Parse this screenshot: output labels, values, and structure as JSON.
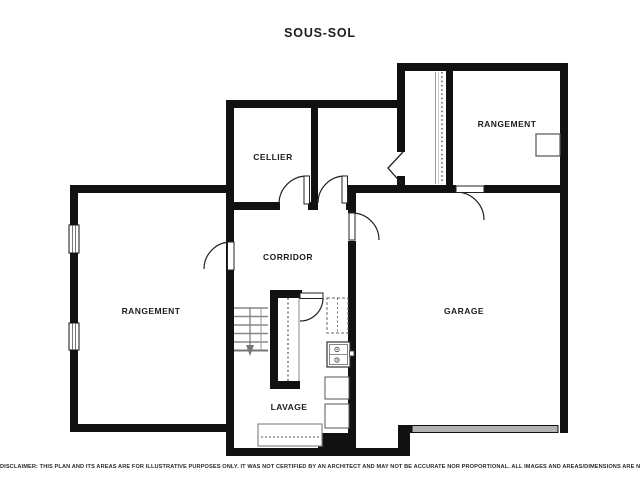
{
  "title": "SOUS-SOL",
  "rooms": {
    "cellier": "CELLIER",
    "rangement_top_right": "RANGEMENT",
    "rangement_left": "RANGEMENT",
    "corridor": "CORRIDOR",
    "garage": "GARAGE",
    "lavage": "LAVAGE"
  },
  "disclaimer": "DISCLAIMER: THIS PLAN AND ITS AREAS ARE FOR ILLUSTRATIVE PURPOSES ONLY. IT WAS NOT CERTIFIED BY AN ARCHITECT AND MAY NOT BE ACCURATE NOR PROPORTIONAL. ALL IMAGES AND AREAS/DIMENSIONS ARE NOT INTENDED TO FORM ANY CONTRACT OR WARRANTY.",
  "colors": {
    "wall": "#111111",
    "garage_door_fill": "#b3b3b3",
    "text": "#222222"
  }
}
